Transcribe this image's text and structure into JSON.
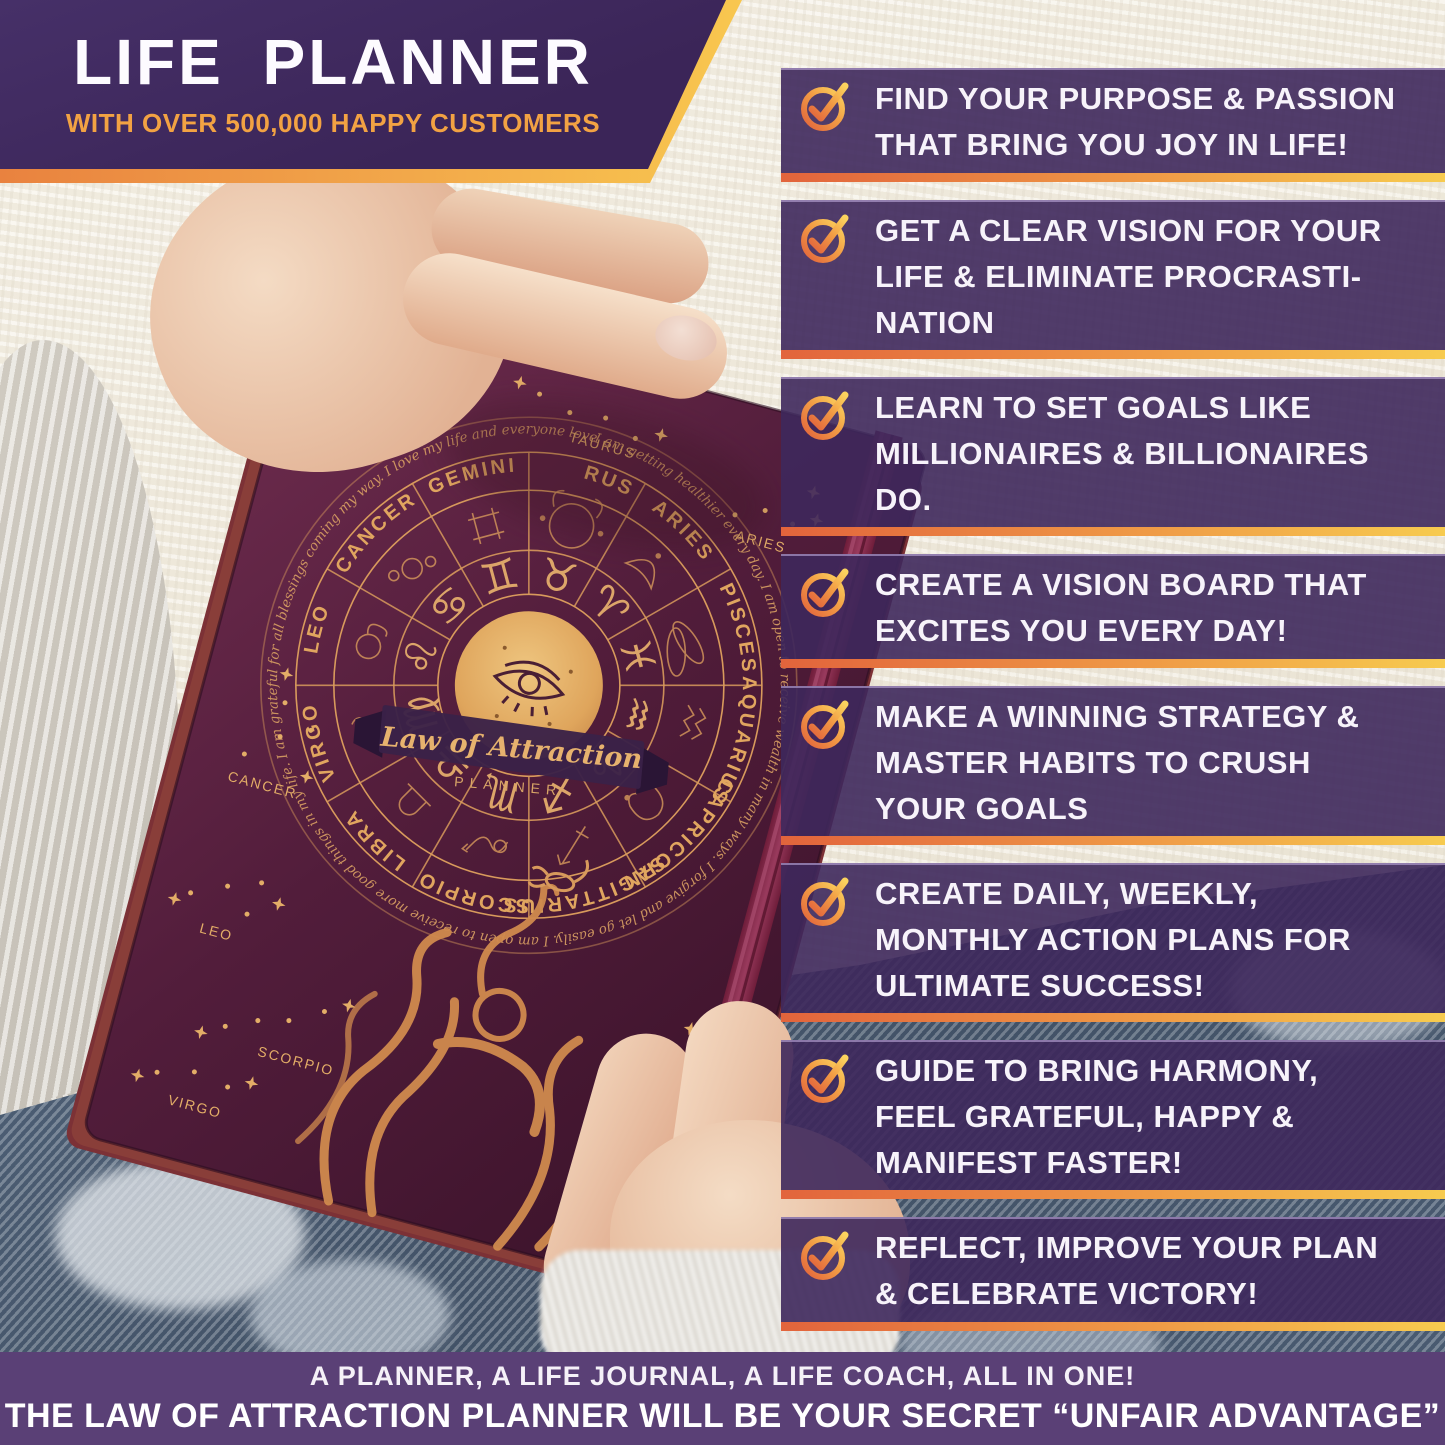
{
  "header": {
    "title": "LIFE PLANNER",
    "subtitle": "WITH OVER 500,000 HAPPY CUSTOMERS"
  },
  "benefits": [
    {
      "lines": [
        "FIND YOUR PURPOSE & PASSION",
        "THAT BRING YOU JOY IN LIFE!"
      ]
    },
    {
      "lines": [
        "GET A CLEAR VISION FOR YOUR",
        "LIFE & ELIMINATE PROCRASTI-",
        "NATION"
      ]
    },
    {
      "lines": [
        "LEARN TO SET GOALS LIKE",
        "MILLIONAIRES & BILLIONAIRES",
        "DO."
      ]
    },
    {
      "lines": [
        "CREATE A VISION BOARD THAT",
        "EXCITES YOU EVERY DAY!"
      ]
    },
    {
      "lines": [
        "MAKE A WINNING STRATEGY &",
        "MASTER HABITS TO CRUSH",
        "YOUR GOALS"
      ]
    },
    {
      "lines": [
        "CREATE DAILY, WEEKLY,",
        "MONTHLY ACTION PLANS FOR",
        "ULTIMATE SUCCESS!"
      ]
    },
    {
      "lines": [
        "GUIDE TO BRING HARMONY,",
        "FEEL GRATEFUL, HAPPY &",
        "MANIFEST FASTER!"
      ]
    },
    {
      "lines": [
        "REFLECT, IMPROVE YOUR PLAN",
        "& CELEBRATE VICTORY!"
      ]
    }
  ],
  "footer": {
    "line1": "A PLANNER, A LIFE JOURNAL, A LIFE COACH, ALL IN ONE!",
    "line2": "THE LAW OF ATTRACTION PLANNER WILL BE YOUR SECRET “UNFAIR ADVANTAGE”"
  },
  "planner": {
    "brand_script": "Law of Attraction",
    "brand_sub": "PLANNER",
    "zodiac_names": [
      "TAURUS",
      "ARIES",
      "PISCES",
      "AQUARIUS",
      "CAPRICORN",
      "SAGITTARIUS",
      "SCORPIO",
      "LIBRA",
      "VIRGO",
      "LEO",
      "CANCER",
      "GEMINI"
    ],
    "zodiac_glyphs": [
      "♉",
      "♈",
      "♓",
      "♒",
      "♑",
      "♐",
      "♏",
      "♎",
      "♍",
      "♌",
      "♋",
      "♊"
    ],
    "constellation_labels": [
      "TAURUS",
      "ARIES",
      "CANCER",
      "LEO",
      "SCORPIO",
      "VIRGO"
    ],
    "affirmations": "I am getting healthier every day.  I am open to receive wealth in many ways.  I forgive and let go easily.  I am open to receive more good things in my life.  I am grateful for all blessings coming my way.  I love my life and everyone loves me.  I am surrounded by loving, caring people in my life."
  },
  "colors": {
    "banner_purple": "#3f2a60",
    "bar_purple": "#3e285c",
    "accent_orange": "#e2643c",
    "accent_gold": "#f7cb4f",
    "cover_maroon": "#521d3b",
    "foil_copper": "#d89a5c",
    "footer_purple": "#5a4076"
  }
}
